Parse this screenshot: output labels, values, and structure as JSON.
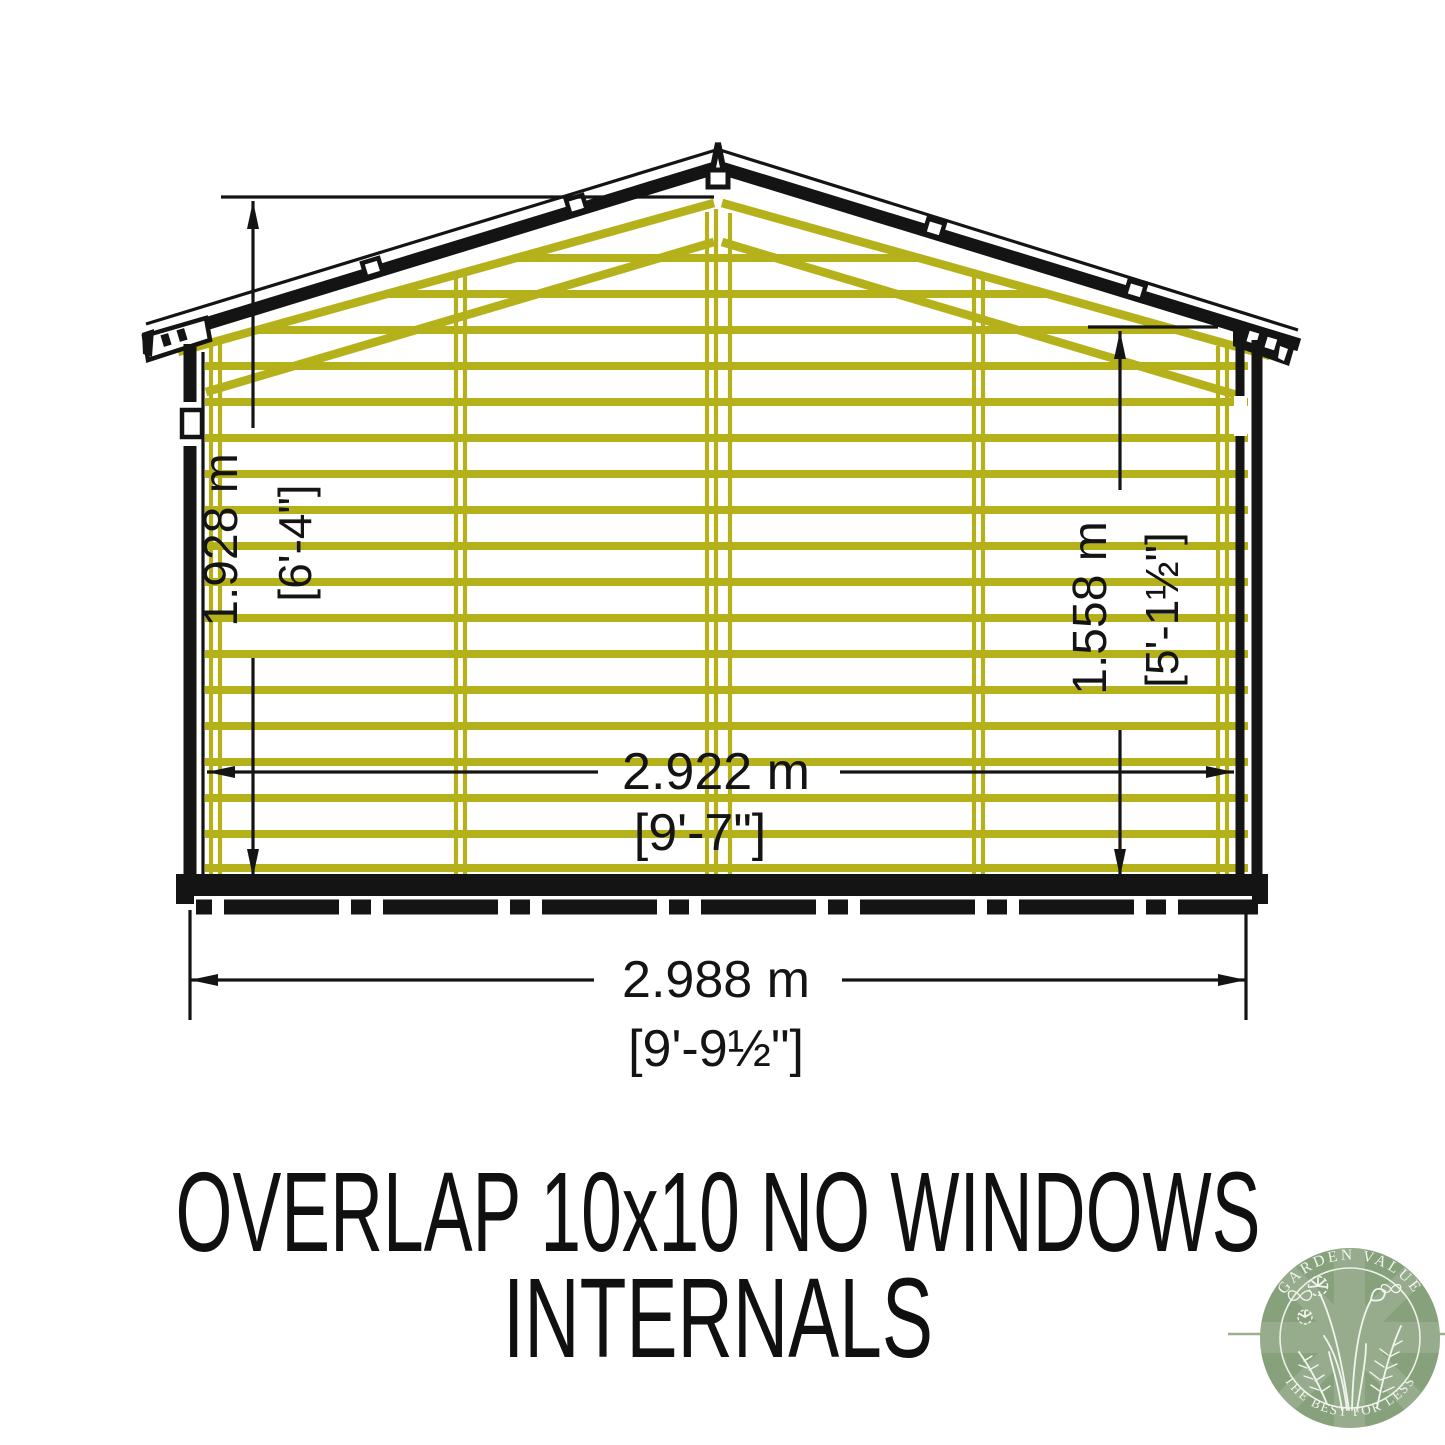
{
  "page": {
    "background": "#ffffff"
  },
  "drawing": {
    "subject": "overlap shed internal elevation",
    "ink_color": "#141414",
    "timber_color": "#b5b11a",
    "dimensions": {
      "ridge_height_metric": "1.928 m",
      "ridge_height_imperial": "[6'-4\"]",
      "eaves_height_metric": "1.558 m",
      "eaves_height_imperial": "[5'-1½\"]",
      "internal_width_metric": "2.922 m",
      "internal_width_imperial": "[9'-7\"]",
      "overall_width_metric": "2.988 m",
      "overall_width_imperial": "[9'-9½\"]"
    }
  },
  "title": {
    "line1": "OVERLAP 10x10 NO WINDOWS",
    "line2": "INTERNALS"
  },
  "logo": {
    "arc_top_text": "GARDEN VALUE",
    "arc_bottom_text": "THE BEST FOR LESS",
    "badge_color": "#87a17d",
    "flag_color": "#a3b79a",
    "ring_color": "#edf1e7",
    "text_color": "#f2f5ee"
  }
}
